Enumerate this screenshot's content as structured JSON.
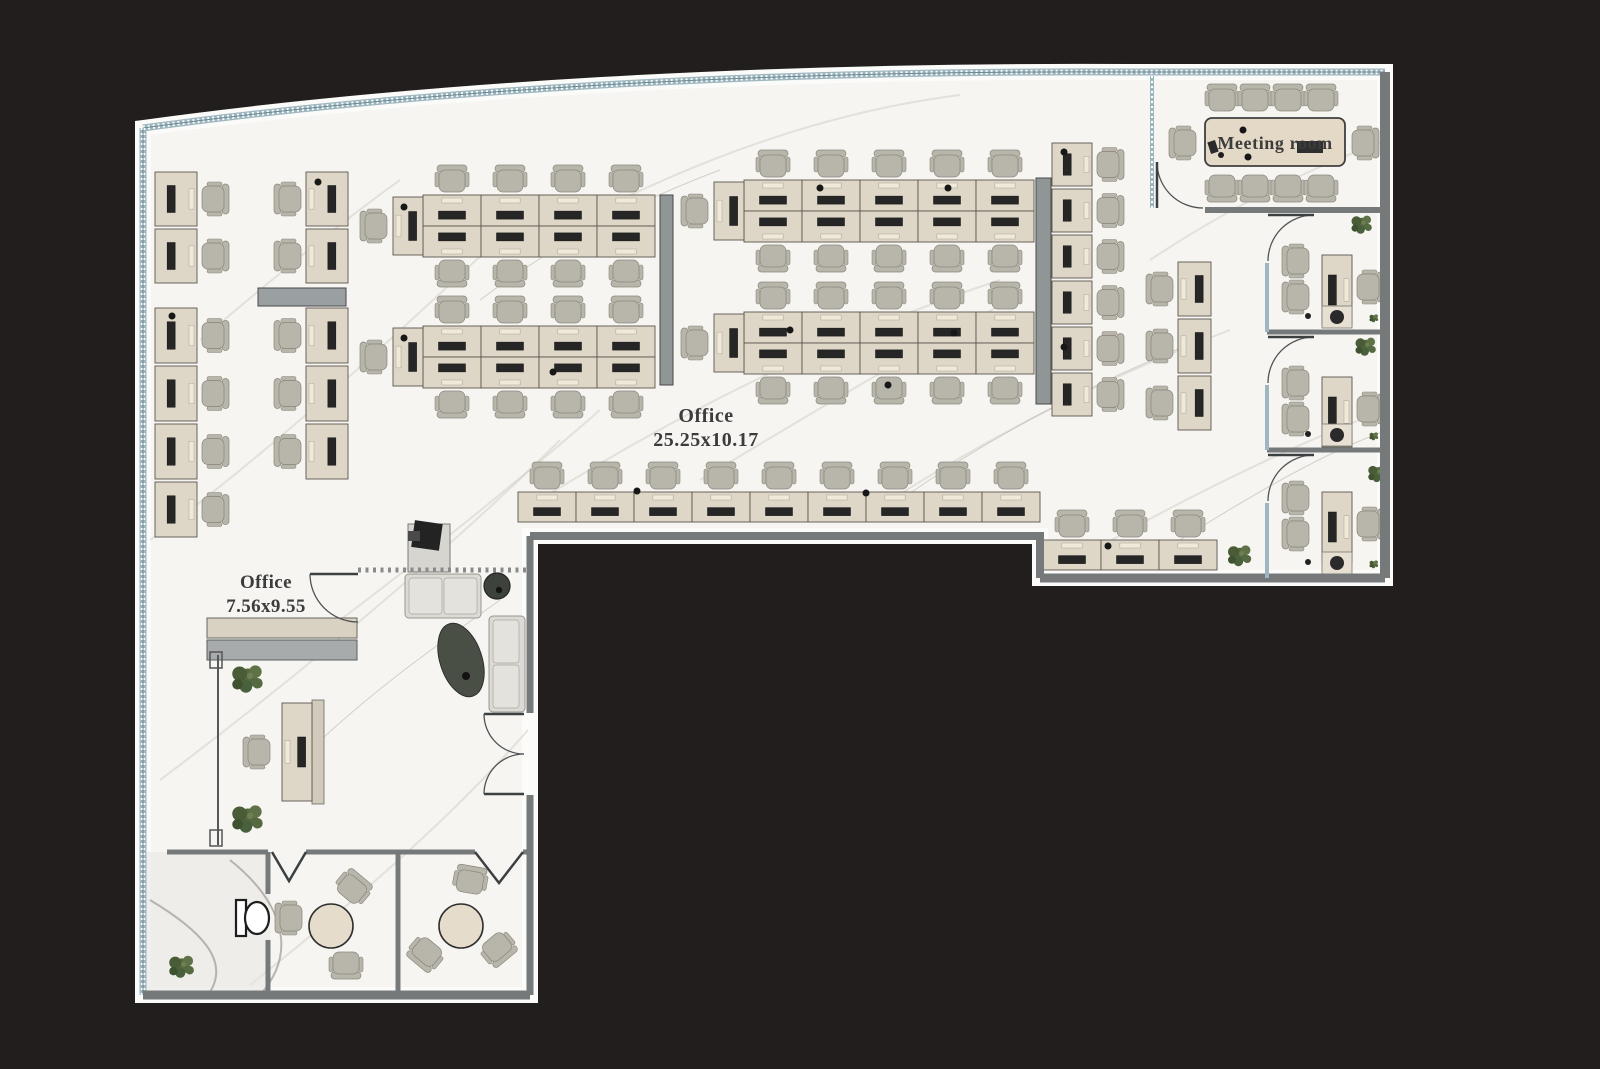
{
  "scene": {
    "type": "office-floor-plan",
    "colors": {
      "bg": "#221e1e",
      "rim": "#fbfbfa",
      "floor": "#f6f5f2",
      "wall": "#75797a",
      "glass": "#9db6bf",
      "veinLight": "#d2cfc9",
      "veinDark": "#bcb8b0",
      "desk": "#ded7c8",
      "deskEdge": "#5a564e",
      "monitor": "#262626",
      "keyboard": "#f0e9d8",
      "chair": "#b8b5ab",
      "chairEdge": "#8a867c",
      "divider": "#909596",
      "sofa": "#dcdad5",
      "table": "#e3d9c6",
      "plant": "#5a6d42",
      "text": "#3c3c3c"
    }
  },
  "rooms": {
    "open_office": {
      "label": "Office",
      "dims": "25.25x10.17"
    },
    "private_office": {
      "label": "Office",
      "dims": "7.56x9.55"
    },
    "meeting_room": {
      "label": "Meeting room"
    }
  }
}
